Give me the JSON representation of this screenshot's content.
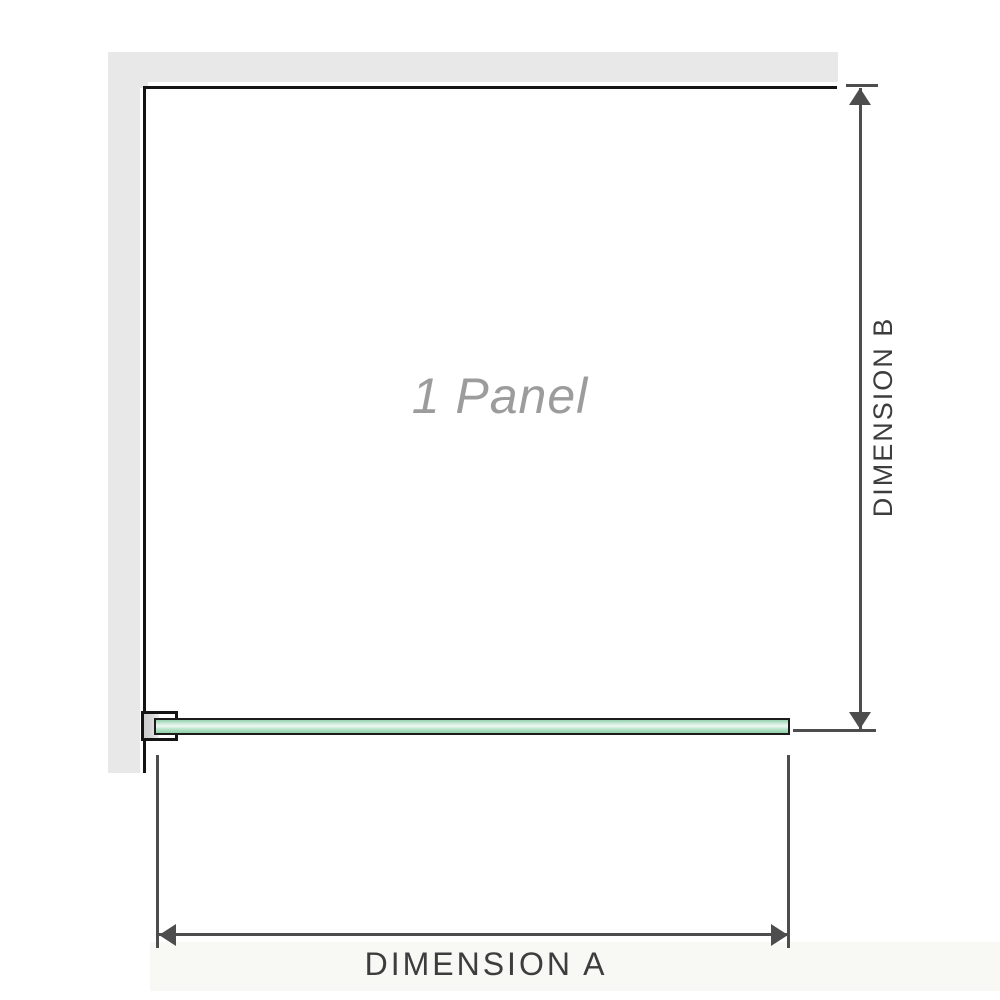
{
  "diagram": {
    "panel_label": "1 Panel",
    "dimensions": {
      "a_label": "DIMENSION A",
      "b_label": "DIMENSION B"
    }
  },
  "colors": {
    "background": "#ffffff",
    "wall": "#e8e8e8",
    "panel_outline": "#141414",
    "dimension_line": "#4d4d4d",
    "dimension_text": "#3d3d3d",
    "panel_label_text": "#9c9c9c",
    "glass_border": "#1c1c1c",
    "glass_green_top": "#94d2ac",
    "glass_green_mid": "#eef8f2",
    "glass_green_bottom": "#8fd0a8",
    "bracket_fill": "#d6d6d6"
  }
}
